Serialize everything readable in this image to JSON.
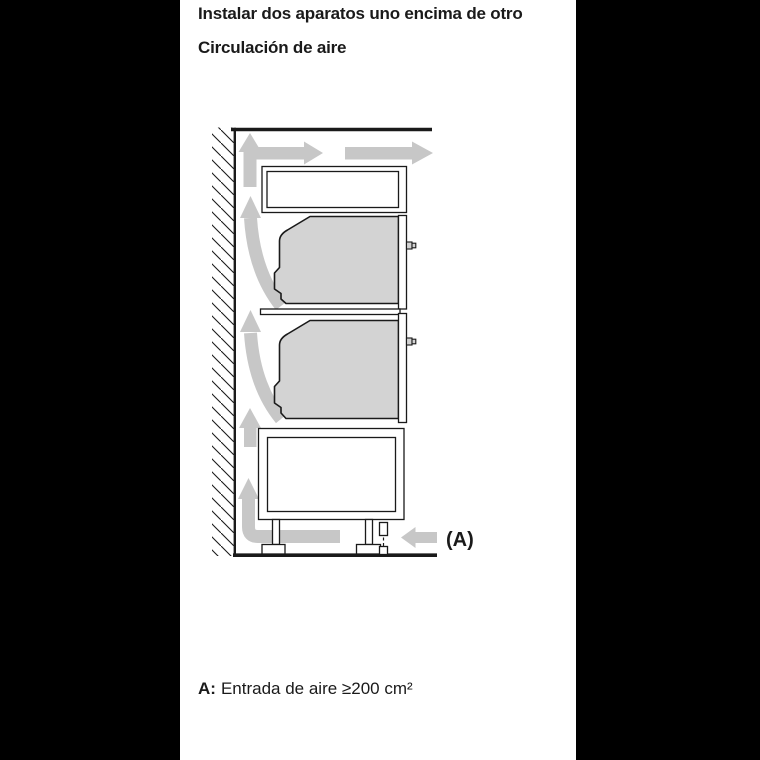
{
  "header": {
    "title": "Instalar dos aparatos uno encima de otro",
    "subtitle": "Circulación de aire"
  },
  "diagram": {
    "inlet_label": "(A)",
    "colors": {
      "arrow": "#c7c7c7",
      "appliance_fill": "#d3d3d3",
      "outline": "#1a1a1a",
      "page_background": "#000000",
      "panel_background": "#ffffff"
    }
  },
  "note": {
    "label": "A:",
    "text": "Entrada de aire ≥200 cm²"
  }
}
